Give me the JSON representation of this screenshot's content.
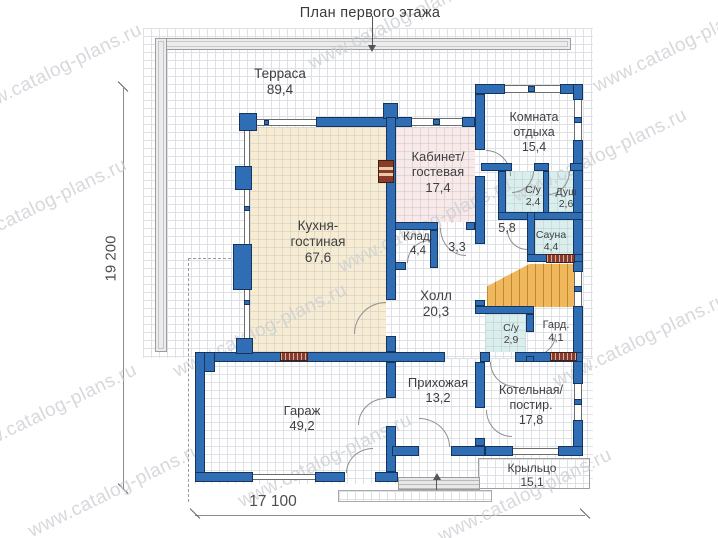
{
  "title": "План первого этажа",
  "watermark_text": "www.catalog-plans.ru",
  "dimensions": {
    "vertical": "19 200",
    "horizontal": "17 100"
  },
  "rooms": [
    {
      "id": "terrace",
      "lines": [
        "Терраса",
        "89,4"
      ]
    },
    {
      "id": "rest-room",
      "lines": [
        "Комната",
        "отдыха",
        "15,4"
      ]
    },
    {
      "id": "cabinet-guest",
      "lines": [
        "Кабинет/",
        "гостевая",
        "17,4"
      ]
    },
    {
      "id": "wc-24",
      "lines": [
        "С/у",
        "2,4"
      ]
    },
    {
      "id": "shower",
      "lines": [
        "Душ",
        "2,6"
      ]
    },
    {
      "id": "corridor-58",
      "lines": [
        "5,8"
      ]
    },
    {
      "id": "sauna",
      "lines": [
        "Сауна",
        "4,4"
      ]
    },
    {
      "id": "storage",
      "lines": [
        "Клад.",
        "4,4"
      ]
    },
    {
      "id": "corridor-33",
      "lines": [
        "3,3"
      ]
    },
    {
      "id": "kitchen-living",
      "lines": [
        "Кухня-",
        "гостиная",
        "67,6"
      ]
    },
    {
      "id": "hall",
      "lines": [
        "Холл",
        "20,3"
      ]
    },
    {
      "id": "wc-29",
      "lines": [
        "С/у",
        "2,9"
      ]
    },
    {
      "id": "wardrobe",
      "lines": [
        "Гард.",
        "4,1"
      ]
    },
    {
      "id": "hallway",
      "lines": [
        "Прихожая",
        "13,2"
      ]
    },
    {
      "id": "garage",
      "lines": [
        "Гараж",
        "49,2"
      ]
    },
    {
      "id": "boiler-laundry",
      "lines": [
        "Котельная/",
        "постир.",
        "17,8"
      ]
    },
    {
      "id": "porch",
      "lines": [
        "Крыльцо",
        "15,1"
      ]
    }
  ],
  "colors": {
    "wall": "#2f6eb5",
    "walloutline": "#16355c",
    "kitchen": "#f7ecd2",
    "cabinet": "#f9e9e9",
    "wet": "#d9efee",
    "stairs": "#f1b75c",
    "radiator": "#8a3a28",
    "gridline": "#dde0e4",
    "terrace": "#ececec",
    "watermark": "#c9ccd1"
  }
}
